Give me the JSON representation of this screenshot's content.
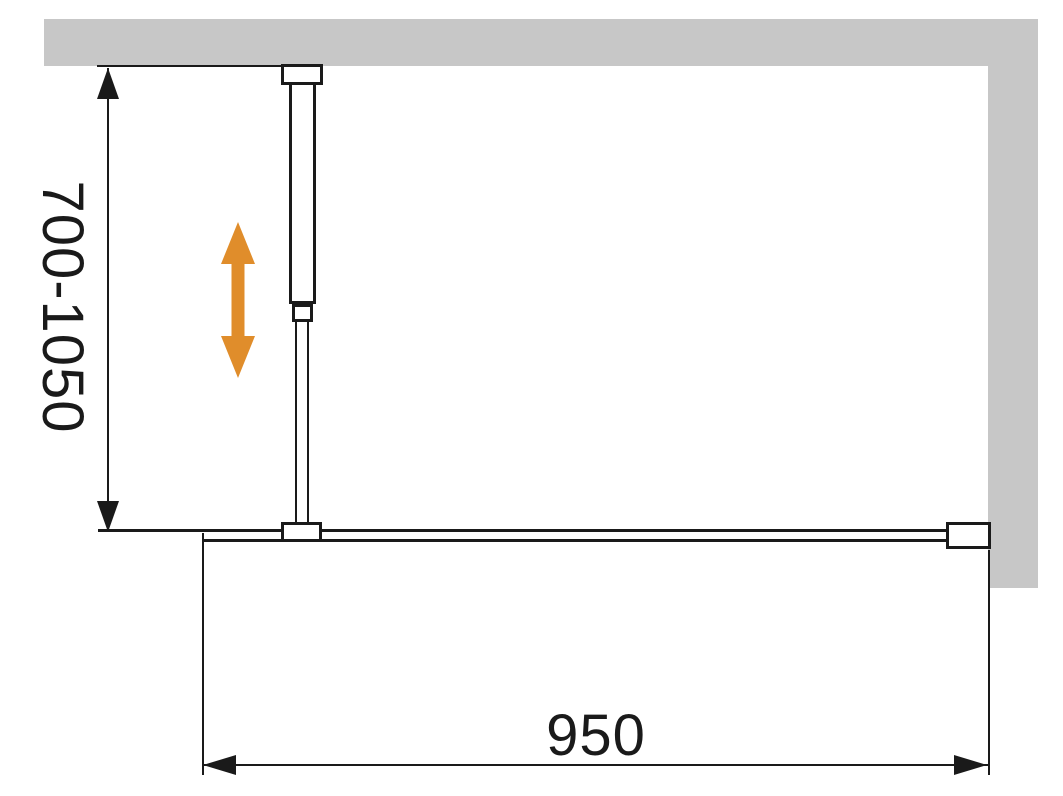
{
  "diagram": {
    "type": "shower-screen-installation-dimension-drawing",
    "labels": {
      "height_range": "700-1050",
      "width": "950"
    },
    "colors": {
      "background": "#ffffff",
      "wall": "#c7c7c7",
      "line": "#1a1a1a",
      "adjust_arrow": "#e08d2b"
    },
    "parts": {
      "wall_top": "wall (plan view, top)",
      "wall_right": "wall (plan view, right)",
      "glass_panel": "glass panel (plan view)",
      "support_bar": "telescopic support bar",
      "adjustability": "support bar length adjustable 700-1050"
    }
  }
}
